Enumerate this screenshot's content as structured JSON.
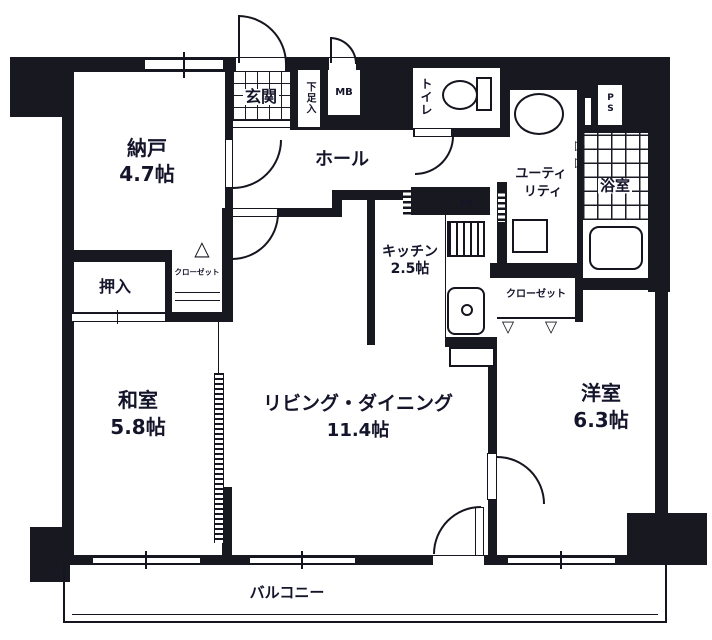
{
  "rooms": {
    "nando": {
      "name": "納戸",
      "size": "4.7帖"
    },
    "genkan": {
      "name": "玄関"
    },
    "getabako": {
      "name": "下足入"
    },
    "mb": {
      "name": "MB"
    },
    "hall": {
      "name": "ホール"
    },
    "toilet": {
      "name": "トイレ"
    },
    "ps_top": {
      "name": "PS"
    },
    "utility": {
      "line1": "ユーティ",
      "line2": "リティ"
    },
    "bath": {
      "name": "浴室"
    },
    "kitchen": {
      "name": "キッチン",
      "size": "2.5帖"
    },
    "ps_kitchen": {
      "name": "PS"
    },
    "closet_bedroom": {
      "name": "クローゼット"
    },
    "closet_nando": {
      "name": "クローゼット"
    },
    "oshiire": {
      "name": "押入"
    },
    "washitsu": {
      "name": "和室",
      "size": "5.8帖"
    },
    "living": {
      "name": "リビング・ダイニング",
      "size": "11.4帖"
    },
    "yoshitsu": {
      "name": "洋室",
      "size": "6.3帖"
    },
    "balcony": {
      "name": "バルコニー"
    }
  },
  "symbols": {
    "fold_up": "△",
    "fold_down": "▽",
    "fold_right": "▷"
  },
  "colors": {
    "wall": "#181820",
    "background": "#ffffff",
    "text": "#14142a"
  }
}
